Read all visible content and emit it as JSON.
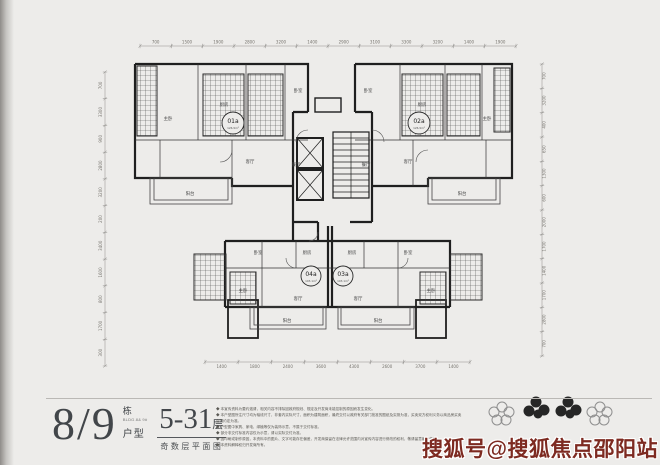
{
  "page": {
    "background": "#edecea"
  },
  "plan": {
    "units": [
      {
        "code": "01a",
        "area": "126.9m²"
      },
      {
        "code": "02a",
        "area": "126.9m²"
      },
      {
        "code": "04a",
        "area": "103.1m²"
      },
      {
        "code": "03a",
        "area": "103.1m²"
      }
    ],
    "rooms": {
      "living": "客厅",
      "dining": "餐厅",
      "master": "主卧",
      "bedroom": "卧室",
      "kitchen": "厨房",
      "bath": "卫生间",
      "balcony": "阳台",
      "hall": "玄关"
    },
    "dims": {
      "top": [
        "700",
        "1500",
        "1900",
        "2800",
        "3200",
        "1400",
        "2900",
        "3100",
        "3300",
        "3200",
        "1400",
        "1900"
      ],
      "bottom": [
        "1400",
        "1800",
        "2400",
        "3600",
        "4300",
        "2600",
        "3700",
        "1400"
      ],
      "left": [
        "700",
        "3300",
        "900",
        "2800",
        "3200",
        "200",
        "3400",
        "1600",
        "800",
        "1700",
        "300"
      ],
      "right": [
        "700",
        "3200",
        "400",
        "650",
        "1300",
        "600",
        "2000",
        "1700",
        "1400",
        "1700",
        "2800",
        "700"
      ]
    }
  },
  "title_block": {
    "building_number": "8/9",
    "building_unit": "栋",
    "building_sub": "BLDG.8& 9#",
    "type_label": "户型",
    "floor_range": "5-31",
    "floor_unit": "层",
    "plan_caption": "奇数层平面图"
  },
  "disclaimer": {
    "lines": [
      "◆ 本宣传资料为要约邀请，相关内容不排除因政府规划、规定及开发商未能控制的原因而发生变化。",
      "◆ 本户型图所注尺寸均为轴线尺寸，非套内实际尺寸，面积为建筑面积，最终交付以政府有关部门批准的图纸及实测为准，买卖双方权利义务以商品房买卖合同约定为准。",
      "◆ 户型图中家具、家电、绿植等仅为装饰示意，不属于交付标准。",
      "◆ 部分非交付标准内容仅为示意，请以实际交付为准。",
      "◆ 因印刷或制作原因，本资料中的图片、文字可能存在偏差，开发商保留在法律允许范围内对宣传内容进行修改的权利，敬请留意最新资料。",
      "◆ 本资料解释权归开发商所有。"
    ]
  },
  "watermark": {
    "text": "搜狐号@搜狐焦点邵阳站",
    "color": "#7d2a21"
  }
}
